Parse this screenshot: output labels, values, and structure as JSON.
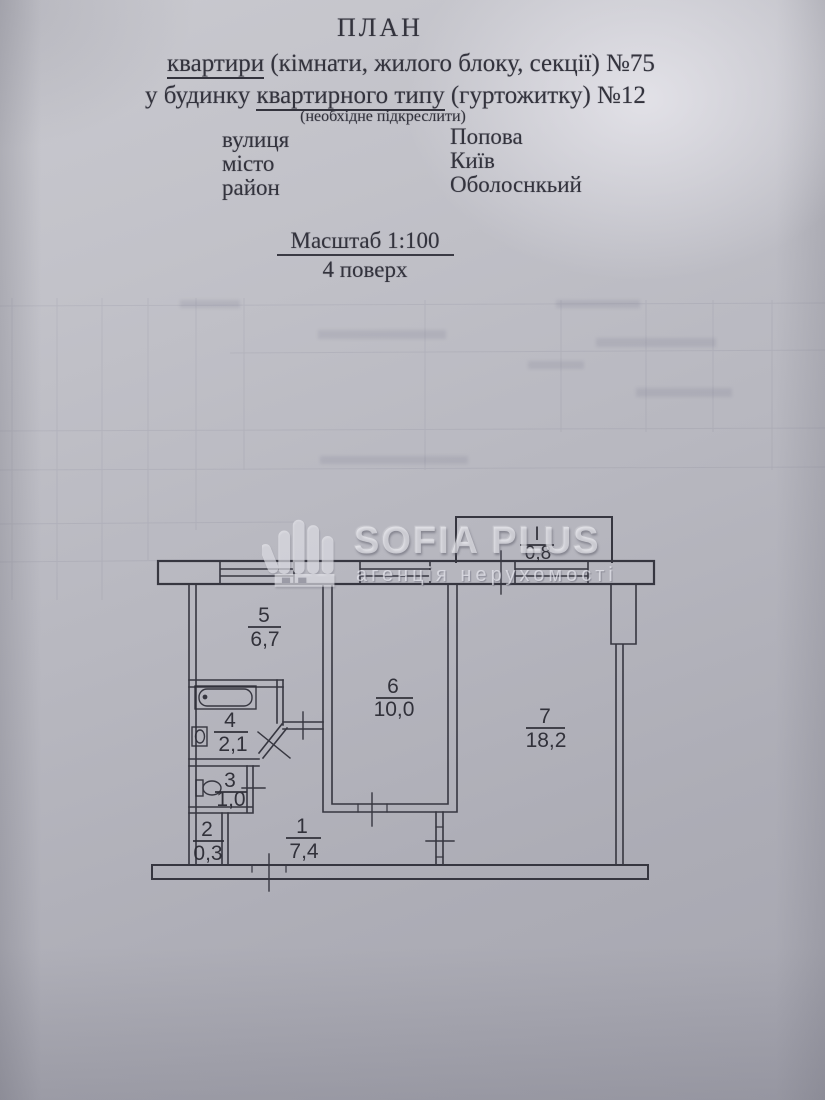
{
  "header": {
    "title": "ПЛАН",
    "line1": {
      "underlined": "квартири",
      "rest": " (кімнати, жилого блоку, секції)  №75"
    },
    "line2": {
      "pre": "у будинку ",
      "underlined": "квартирного типу",
      "rest": " (гуртожитку) №12"
    },
    "note": "(необхідне підкреслити)",
    "address": [
      {
        "label": "вулиця",
        "value": "Попова"
      },
      {
        "label": "місто",
        "value": "Київ"
      },
      {
        "label": "район",
        "value": "Оболоснкьий"
      }
    ],
    "scale": "Масштаб 1:100",
    "floor": "4 поверх"
  },
  "watermark": {
    "brand": "SOFIA PLUS",
    "tagline": "агенція нерухомості"
  },
  "plan": {
    "balcony": {
      "num": "І",
      "area": "0,8"
    },
    "rooms": [
      {
        "num": "1",
        "area": "7,4"
      },
      {
        "num": "2",
        "area": "0,3"
      },
      {
        "num": "3",
        "area": "1,0"
      },
      {
        "num": "4",
        "area": "2,1"
      },
      {
        "num": "5",
        "area": "6,7"
      },
      {
        "num": "6",
        "area": "10,0"
      },
      {
        "num": "7",
        "area": "18,2"
      }
    ]
  }
}
